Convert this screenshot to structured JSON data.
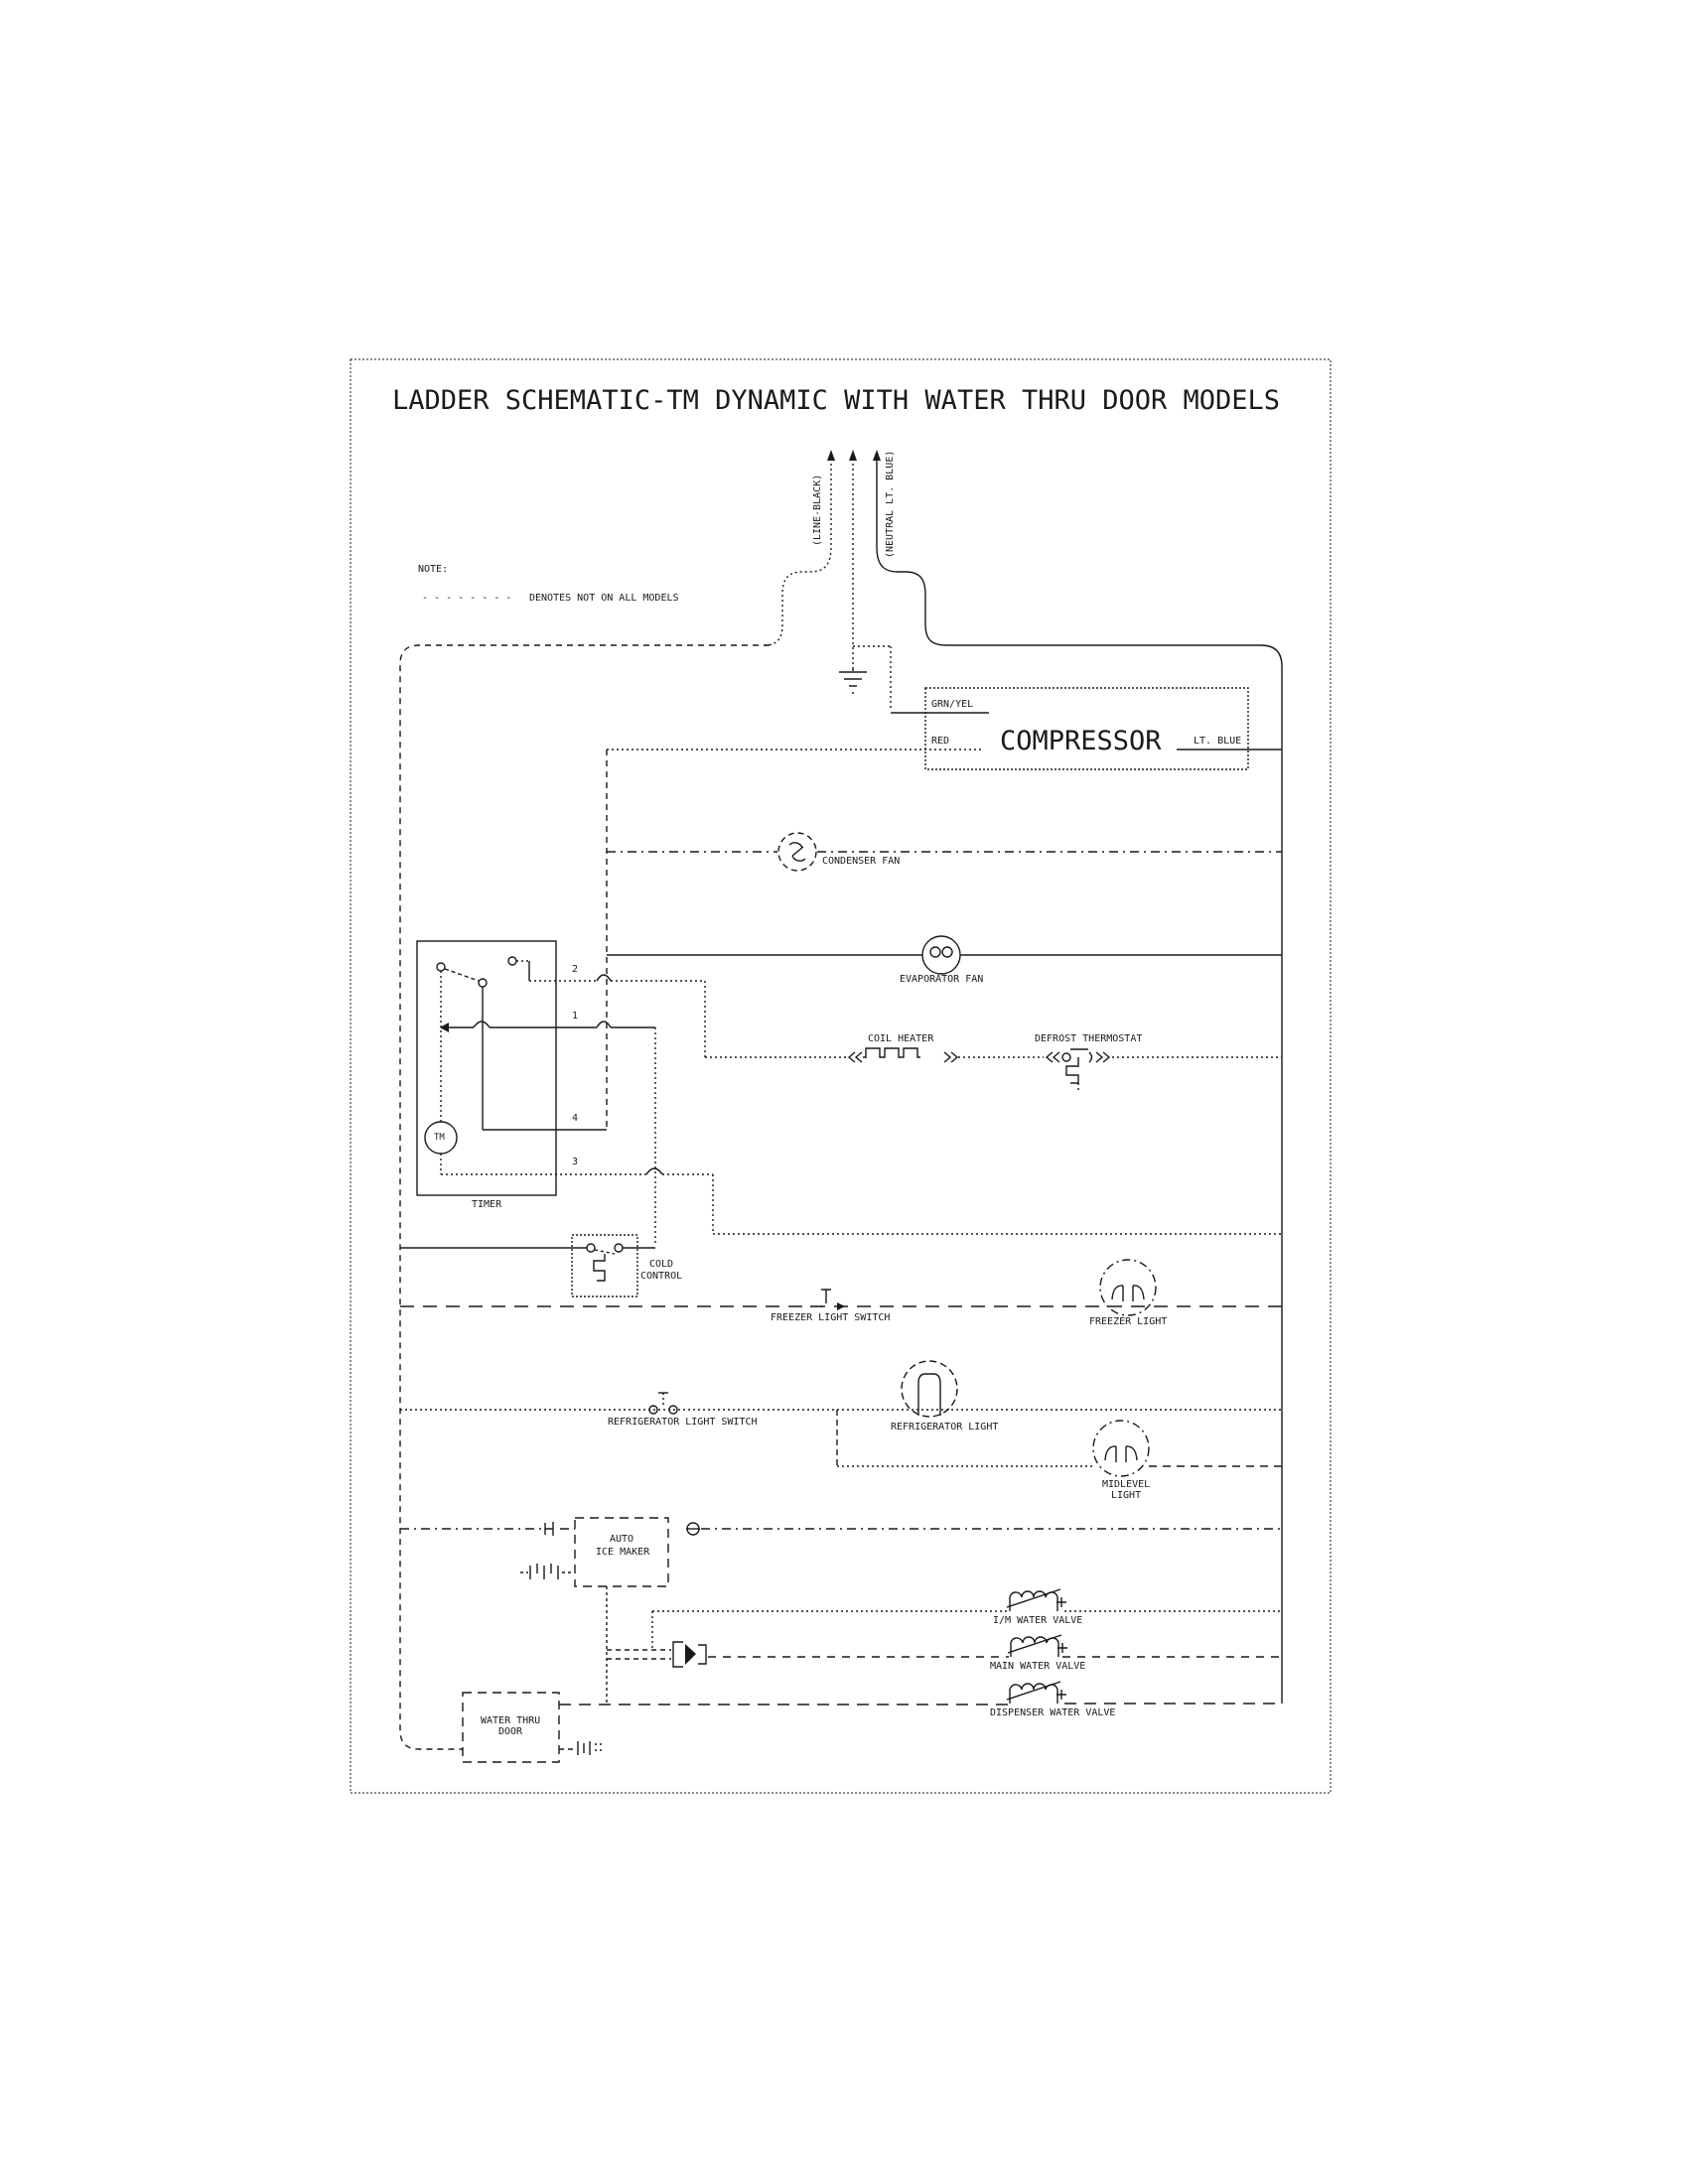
{
  "colors": {
    "ink": "#1a1a1a",
    "paper": "#ffffff"
  },
  "title": "LADDER SCHEMATIC-TM DYNAMIC WITH WATER THRU DOOR MODELS",
  "note": {
    "label": "NOTE:",
    "dashes": "- - - - - - - -",
    "text": "DENOTES NOT ON ALL MODELS"
  },
  "supply": {
    "line": "(LINE-BLACK)",
    "neutral": "(NEUTRAL LT. BLUE)"
  },
  "compressor": {
    "grn_yel": "GRN/YEL",
    "red": "RED",
    "name": "COMPRESSOR",
    "lt_blue": "LT. BLUE"
  },
  "components": {
    "condenser_fan": "CONDENSER FAN",
    "evaporator_fan": "EVAPORATOR FAN",
    "coil_heater": "COIL HEATER",
    "defrost_thermostat": "DEFROST THERMOSTAT",
    "freezer_light_switch": "FREEZER LIGHT SWITCH",
    "freezer_light": "FREEZER LIGHT",
    "refrigerator_light_switch": "REFRIGERATOR LIGHT SWITCH",
    "refrigerator_light": "REFRIGERATOR LIGHT",
    "midlevel_light_1": "MIDLEVEL",
    "midlevel_light_2": "LIGHT",
    "im_water_valve": "I/M WATER VALVE",
    "main_water_valve": "MAIN WATER VALVE",
    "dispenser_water_valve": "DISPENSER WATER VALVE"
  },
  "timer": {
    "label": "TIMER",
    "motor": "TM",
    "terminal_1": "1",
    "terminal_2": "2",
    "terminal_3": "3",
    "terminal_4": "4"
  },
  "cold_control": {
    "line1": "COLD",
    "line2": "CONTROL"
  },
  "ice_maker": {
    "line1": "AUTO",
    "line2": "ICE MAKER"
  },
  "water_thru_door": {
    "line1": "WATER THRU",
    "line2": "DOOR"
  }
}
